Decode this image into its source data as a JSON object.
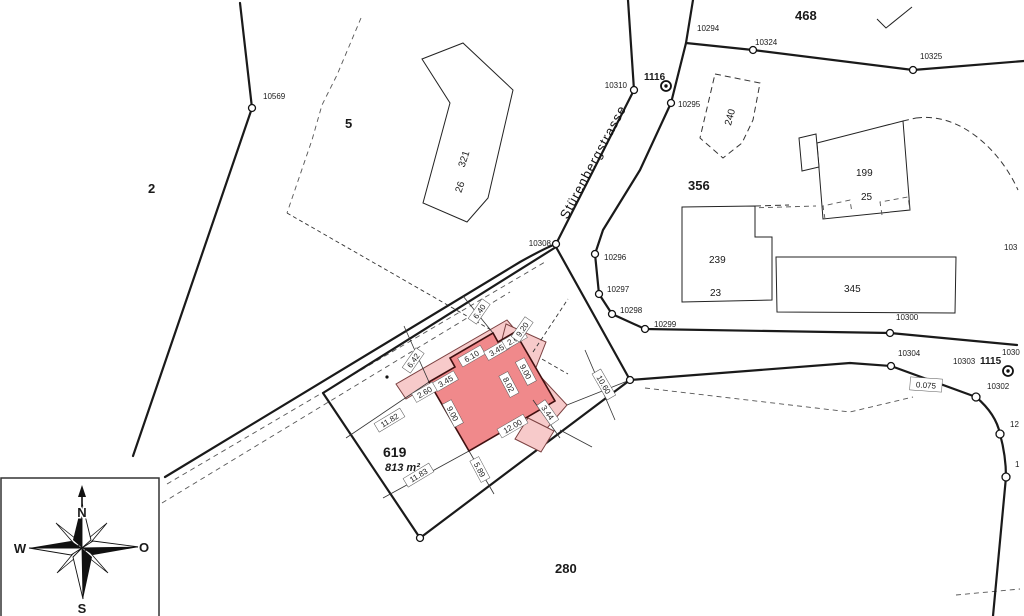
{
  "street": {
    "name": "Stürenbergstrasse"
  },
  "parcels": {
    "p2": "2",
    "p5": "5",
    "p468": "468",
    "p356": "356",
    "p619": "619",
    "p619_area": "813 m²",
    "p280": "280"
  },
  "buildings": {
    "b321": "321",
    "b321_house": "26",
    "b240": "240",
    "b199": "199",
    "b199_house": "25",
    "b239": "239",
    "b239_house": "23",
    "b345": "345"
  },
  "points": {
    "pt10569": "10569",
    "pt10294": "10294",
    "pt10324": "10324",
    "pt10325": "10325",
    "pt10310": "10310",
    "pt1116": "1116",
    "pt10295": "10295",
    "pt10308": "10308",
    "pt10296": "10296",
    "pt10297": "10297",
    "pt10298": "10298",
    "pt10299": "10299",
    "pt10300": "10300",
    "pt10304": "10304",
    "pt10303": "10303",
    "pt1115": "1115",
    "pt10302": "10302",
    "pt1030": "1030",
    "pt103": "103",
    "pt12": "12",
    "pt1": "1"
  },
  "measurements": {
    "m1182": "11.82",
    "m1183": "11.83",
    "m589": "5.89",
    "m900l": "9.00",
    "m1200": "12.00",
    "m260a": "2.60",
    "m345a": "3.45",
    "m610": "6.10",
    "m345b": "3.45",
    "m260b": "2.60",
    "m640": "6.40",
    "m642": "6.42",
    "m920": "9.20",
    "m900r": "9.00",
    "m802": "8.02",
    "m344": "3.44",
    "m1060": "10.60",
    "m0075": "0.075"
  },
  "compass": {
    "n": "N",
    "s": "S",
    "w": "W",
    "o": "O"
  }
}
